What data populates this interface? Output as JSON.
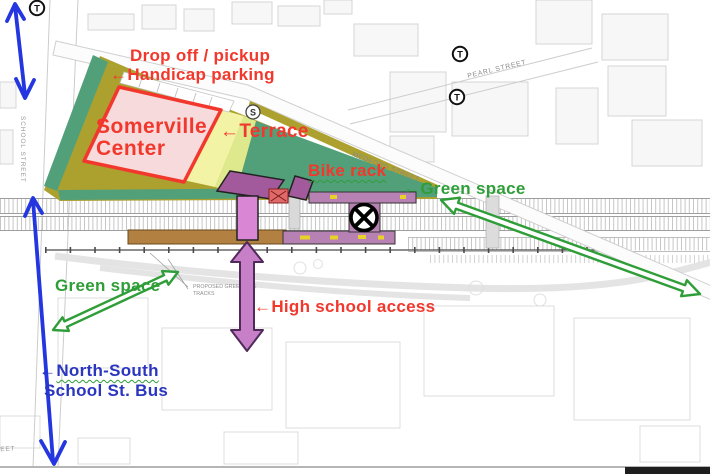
{
  "labels": {
    "drop_off_pickup": "Drop off / pickup",
    "handicap_parking": "Handicap parking",
    "somerville_center_line1": "Somerville",
    "somerville_center_line2": "Center",
    "terrace": "Terrace",
    "bike_rack": "Bike rack",
    "green_space_upper": "Green space",
    "green_space_lower": "Green space",
    "high_school_access": "High school access",
    "north_south": "North-South",
    "school_st_bus": "School St. Bus"
  },
  "streets": {
    "pearl": "PEARL STREET",
    "medford": "MEDFORD STREET",
    "school": "SCHOOL STREET",
    "partial_bottom_left": "STREET",
    "proposed_green_line_1": "PROPOSED GREEN LINE",
    "proposed_green_line_2": "TRACKS"
  },
  "symbols": {
    "t_logo": "T",
    "s_marker": "S"
  },
  "icons": {
    "arrow_left": "←"
  },
  "colors": {
    "annotation_red": "#f2382c",
    "annotation_green": "#2f9e38",
    "annotation_blue": "#2a35c0",
    "bus_arrow_blue": "#2336df",
    "access_arrow_magenta": "#c77fc8",
    "parcel_pink": "#f7dbdc",
    "parcel_outline_red": "#f2382c",
    "olive_parking": "#aca12f",
    "green_space_teal": "#52a07a",
    "terrace_yellow": "#f2f3a4",
    "canopy_purple": "#a35a9c",
    "platform_purple": "#b781b4",
    "elevator_magenta": "#d987d5",
    "platform_brown": "#b28040"
  }
}
